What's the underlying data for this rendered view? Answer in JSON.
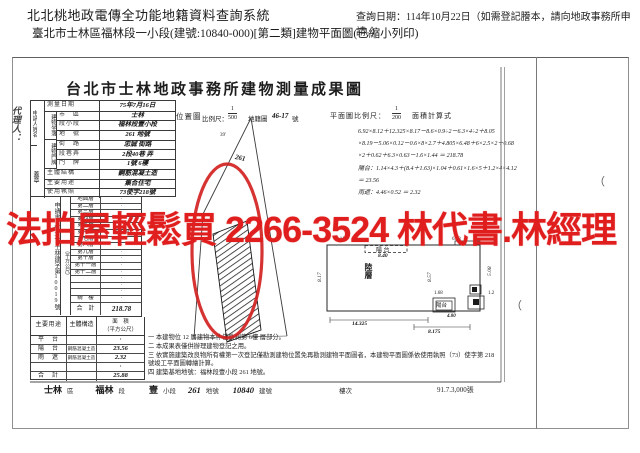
{
  "sys": {
    "title": "北北桃地政電傳全功能地籍資料查詢系統",
    "query_date": "查詢日期：114年10月22日（如需登記謄本，請向地政事務所申請。）",
    "subtitle": "臺北市士林區福林段一小段(建號:10840-000)[第二類]建物平面圖(已縮小列印)"
  },
  "overlay": {
    "ad_text": "法拍屋輕鬆買 2266-3524 林代書.林經理",
    "red": "#e01e1e"
  },
  "doc": {
    "title": "台北市士林地政事務所建物測量成果圖",
    "agent_label": "代理人：",
    "applicant_label": "申請人姓名",
    "seal_label": "蓋章",
    "info_rows": [
      {
        "label": "測量日期",
        "value": "75年7月16日"
      },
      {
        "label": "市　區",
        "value": "士林"
      },
      {
        "label": "段小段",
        "value": "福林段壹小段"
      },
      {
        "label": "地　號",
        "value": "261 地號"
      },
      {
        "label": "街　路",
        "value": "忠誠 街路"
      },
      {
        "label": "段巷弄",
        "value": "2段40巷 弄"
      },
      {
        "label": "門　牌",
        "value": "1號 6樓"
      },
      {
        "label": "主體結構",
        "value": "鋼筋混凝土造"
      },
      {
        "label": "主要用途",
        "value": "集合住宅"
      },
      {
        "label": "使用執照",
        "value": "73使字218號"
      }
    ],
    "group_labels": [
      "建物坐落",
      "建物門牌"
    ],
    "receipt_no": "申請書（93）士林建字第10019號",
    "area_unit": "（平方公尺）",
    "floor_table": {
      "rows": [
        {
          "floor": "地面層",
          "area": "·"
        },
        {
          "floor": "第二層",
          "area": "·"
        },
        {
          "floor": "第三層",
          "area": "·"
        },
        {
          "floor": "第四層",
          "area": "·"
        },
        {
          "floor": "第五層",
          "area": "·"
        },
        {
          "floor": "第六層",
          "area": "218.78"
        },
        {
          "floor": "第七層",
          "area": "·"
        },
        {
          "floor": "第八層",
          "area": "·"
        },
        {
          "floor": "第九層",
          "area": "·"
        },
        {
          "floor": "第十層",
          "area": "·"
        },
        {
          "floor": "第十一層",
          "area": "·"
        },
        {
          "floor": "第十二層",
          "area": "·"
        },
        {
          "floor": "",
          "area": "·"
        },
        {
          "floor": "",
          "area": "·"
        },
        {
          "floor": "",
          "area": "·"
        },
        {
          "floor": "騎　樓",
          "area": "·"
        }
      ],
      "total_label": "合　計",
      "total": "218.78"
    },
    "annex_table": {
      "headers": {
        "use": "主要用途",
        "structure": "主體構造",
        "area1": "面　積",
        "area2": "（平方公尺）"
      },
      "rows": [
        {
          "use": "平　台",
          "structure": "",
          "area": "·"
        },
        {
          "use": "陽　台",
          "structure": "鋼筋混凝土造",
          "area": "23.56"
        },
        {
          "use": "雨　遮",
          "structure": "鋼筋混凝土造",
          "area": "2.32"
        },
        {
          "use": "",
          "structure": "",
          "area": "·"
        },
        {
          "use": "合　計",
          "structure": "",
          "area": "25.88"
        }
      ]
    },
    "location_map": {
      "label": "位置圖",
      "scale_label": "比例尺：",
      "scale_num": "1",
      "scale_den": "500",
      "sheet_prefix": "地籍圖",
      "sheet_no": "46-17",
      "sheet_suffix": "號",
      "parcel_no": "261",
      "bearing": "39'"
    },
    "plan": {
      "scale_label": "平面圖比例尺：",
      "scale_num": "1",
      "scale_den": "200",
      "calc_label": "面積計算式",
      "calc_lines": [
        "6.92×8.12＋12.325×8.17－8.6×0.9÷2－6.3×4÷2＋8.05",
        "×8.19－5.06×0.12－0.6×8×2.7＋4.805×6.48＋6×2.5×2＋0.68",
        "×2＋0.62＋6.3×0.63－1.6×1.44 ＝ 218.78",
        "陽台：1.14×4.3＋(8.4＋1.63)×1.04＋0.61×1.6×5＋1.2×4×4.12",
        "＝ 23.56",
        "雨遮：4.46×0.52 ＝ 2.32"
      ],
      "labels": {
        "balcony_top": "陽 台",
        "dim_top": "8.40",
        "unit_floor": "陸層",
        "dim_left": "8.17",
        "dim_mid": "8.57",
        "dim_right": "5.08",
        "balcony_bottom": "陽台",
        "dim_bb": "1.68",
        "dim_bottom1": "14.325",
        "dim_bottom2": "8.175",
        "dim_bottom3": "4.80",
        "dim_tl": "5.11",
        "dim_tr": "6.13",
        "dim_sr": "1.2"
      }
    },
    "notes": [
      "一 本建物位 12 層建物本件僅勘測第 6樓 層部分。",
      "二 本成果表僅供辦理建物登記之用。",
      "三 依實施建築改良物所有權第一次登記僅勘測建物位置免再勘測建物平面圖者，本建物平面圖係依使用執照（73）使字第 218 號竣工平面圖轉繪計算。",
      "四 建築基地地號：福林段壹小段 261 地號。"
    ],
    "footer": {
      "items": [
        {
          "value": "士林",
          "label": "區"
        },
        {
          "value": "福林",
          "label": "段"
        },
        {
          "value": "壹",
          "label": "小段"
        },
        {
          "value": "261",
          "label": "地號"
        },
        {
          "value": "10840",
          "label": "建號"
        },
        {
          "value": "",
          "label": "樓次"
        }
      ],
      "print_no": "91.7.3,000張"
    },
    "paren_mark": "（"
  }
}
